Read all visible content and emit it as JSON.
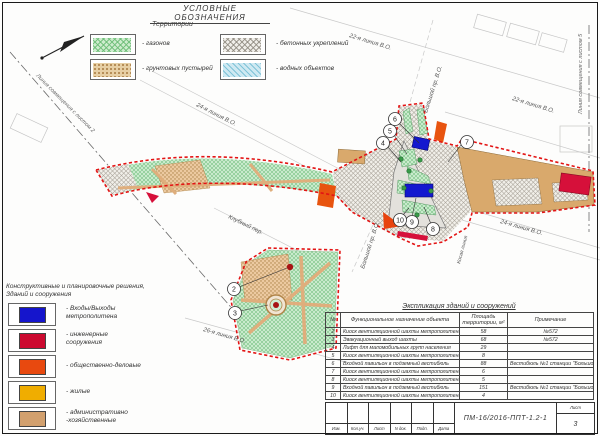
{
  "legend_top": {
    "title": "УСЛОВНЫЕ ОБОЗНАЧЕНИЯ",
    "subtitle": "Территории",
    "items": [
      {
        "label": "- газонов",
        "swatch": "green-hatch",
        "color": "#cdeccd"
      },
      {
        "label": "- грунтовых пустырей",
        "swatch": "brown-dots",
        "color": "#e7cfa4"
      },
      {
        "label": "- бетонных укреплений",
        "swatch": "gray-hatch",
        "color": "#f0eee9"
      },
      {
        "label": "- водных объектов",
        "swatch": "blue-hatch",
        "color": "#cfe9f2"
      }
    ]
  },
  "legend_solutions": {
    "heading": "Конструктивные и планировочные решения,\nЗданий и сооружения",
    "items": [
      {
        "label": "- Входы/Выходы\nметрополитена",
        "color": "#1515cc"
      },
      {
        "label": "- инженерные\nсооружения",
        "color": "#cc0a30"
      },
      {
        "label": "- общественно-деловые",
        "color": "#e8490f"
      },
      {
        "label": "- жилые",
        "color": "#f0ad00"
      },
      {
        "label": "- административно\n-хозяйственные",
        "color": "#d2a06e"
      }
    ]
  },
  "explication": {
    "title": "Экспликация зданий и сооружений",
    "headers": {
      "num": "№",
      "name": "Функциональное назначение объекта",
      "area": "Площадь территории, м²",
      "note": "Примечание"
    },
    "rows": [
      {
        "num": "2",
        "name": "Киоск вентиляционной шахты метрополитена",
        "area": "58",
        "note": "№572"
      },
      {
        "num": "3",
        "name": "Эвакуационный выход шахты",
        "area": "68",
        "note": "№572"
      },
      {
        "num": "4",
        "name": "Лифт для маломобильных групп населения",
        "area": "29",
        "note": ""
      },
      {
        "num": "5",
        "name": "Киоск вентиляционной шахты метрополитена",
        "area": "8",
        "note": ""
      },
      {
        "num": "6",
        "name": "Входной павильон в подземный вестибюль",
        "area": "88",
        "note": "Вестибюль №1 станции \"Большой проспект\""
      },
      {
        "num": "7",
        "name": "Киоск вентиляционной шахты метрополитена",
        "area": "6",
        "note": ""
      },
      {
        "num": "8",
        "name": "Киоск вентиляционной шахты метрополитена",
        "area": "5",
        "note": ""
      },
      {
        "num": "9",
        "name": "Входной павильон в подземный вестибюль",
        "area": "151",
        "note": "Вестибюль №1 станции \"Большой проспект\""
      },
      {
        "num": "10",
        "name": "Киоск вентиляционной шахты метрополитена",
        "area": "4",
        "note": ""
      }
    ]
  },
  "titleblock": {
    "cols": [
      "Изм.",
      "Кол.уч.",
      "Лист",
      "N док.",
      "Подп.",
      "Дата"
    ],
    "doc_number": "ПМ-16/2016-ППТ-1.2-1",
    "sheet_label": "Лист",
    "sheet_number": "3"
  },
  "map": {
    "labels": {
      "line24a": "24-я линия В.О.",
      "line22a": "22-я линия В.О.",
      "line22b": "22-я линия В.О.",
      "line24b": "24-я линия В.О.",
      "line26": "26-я линия В.О.",
      "klubny": "Клубный пер.",
      "kosaya": "Косая линия",
      "bolshoy_top": "Большой пр. В.О.",
      "bolshoy_bottom": "Большой пр. В.О.",
      "match2": "Линия совмещения с листом 2",
      "match5": "Линия совмещения с листом 5"
    },
    "callouts": [
      "2",
      "3",
      "4",
      "5",
      "6",
      "7",
      "8",
      "9",
      "10"
    ],
    "boundary_color": "#e31414",
    "metro_color": "#1318cf"
  }
}
